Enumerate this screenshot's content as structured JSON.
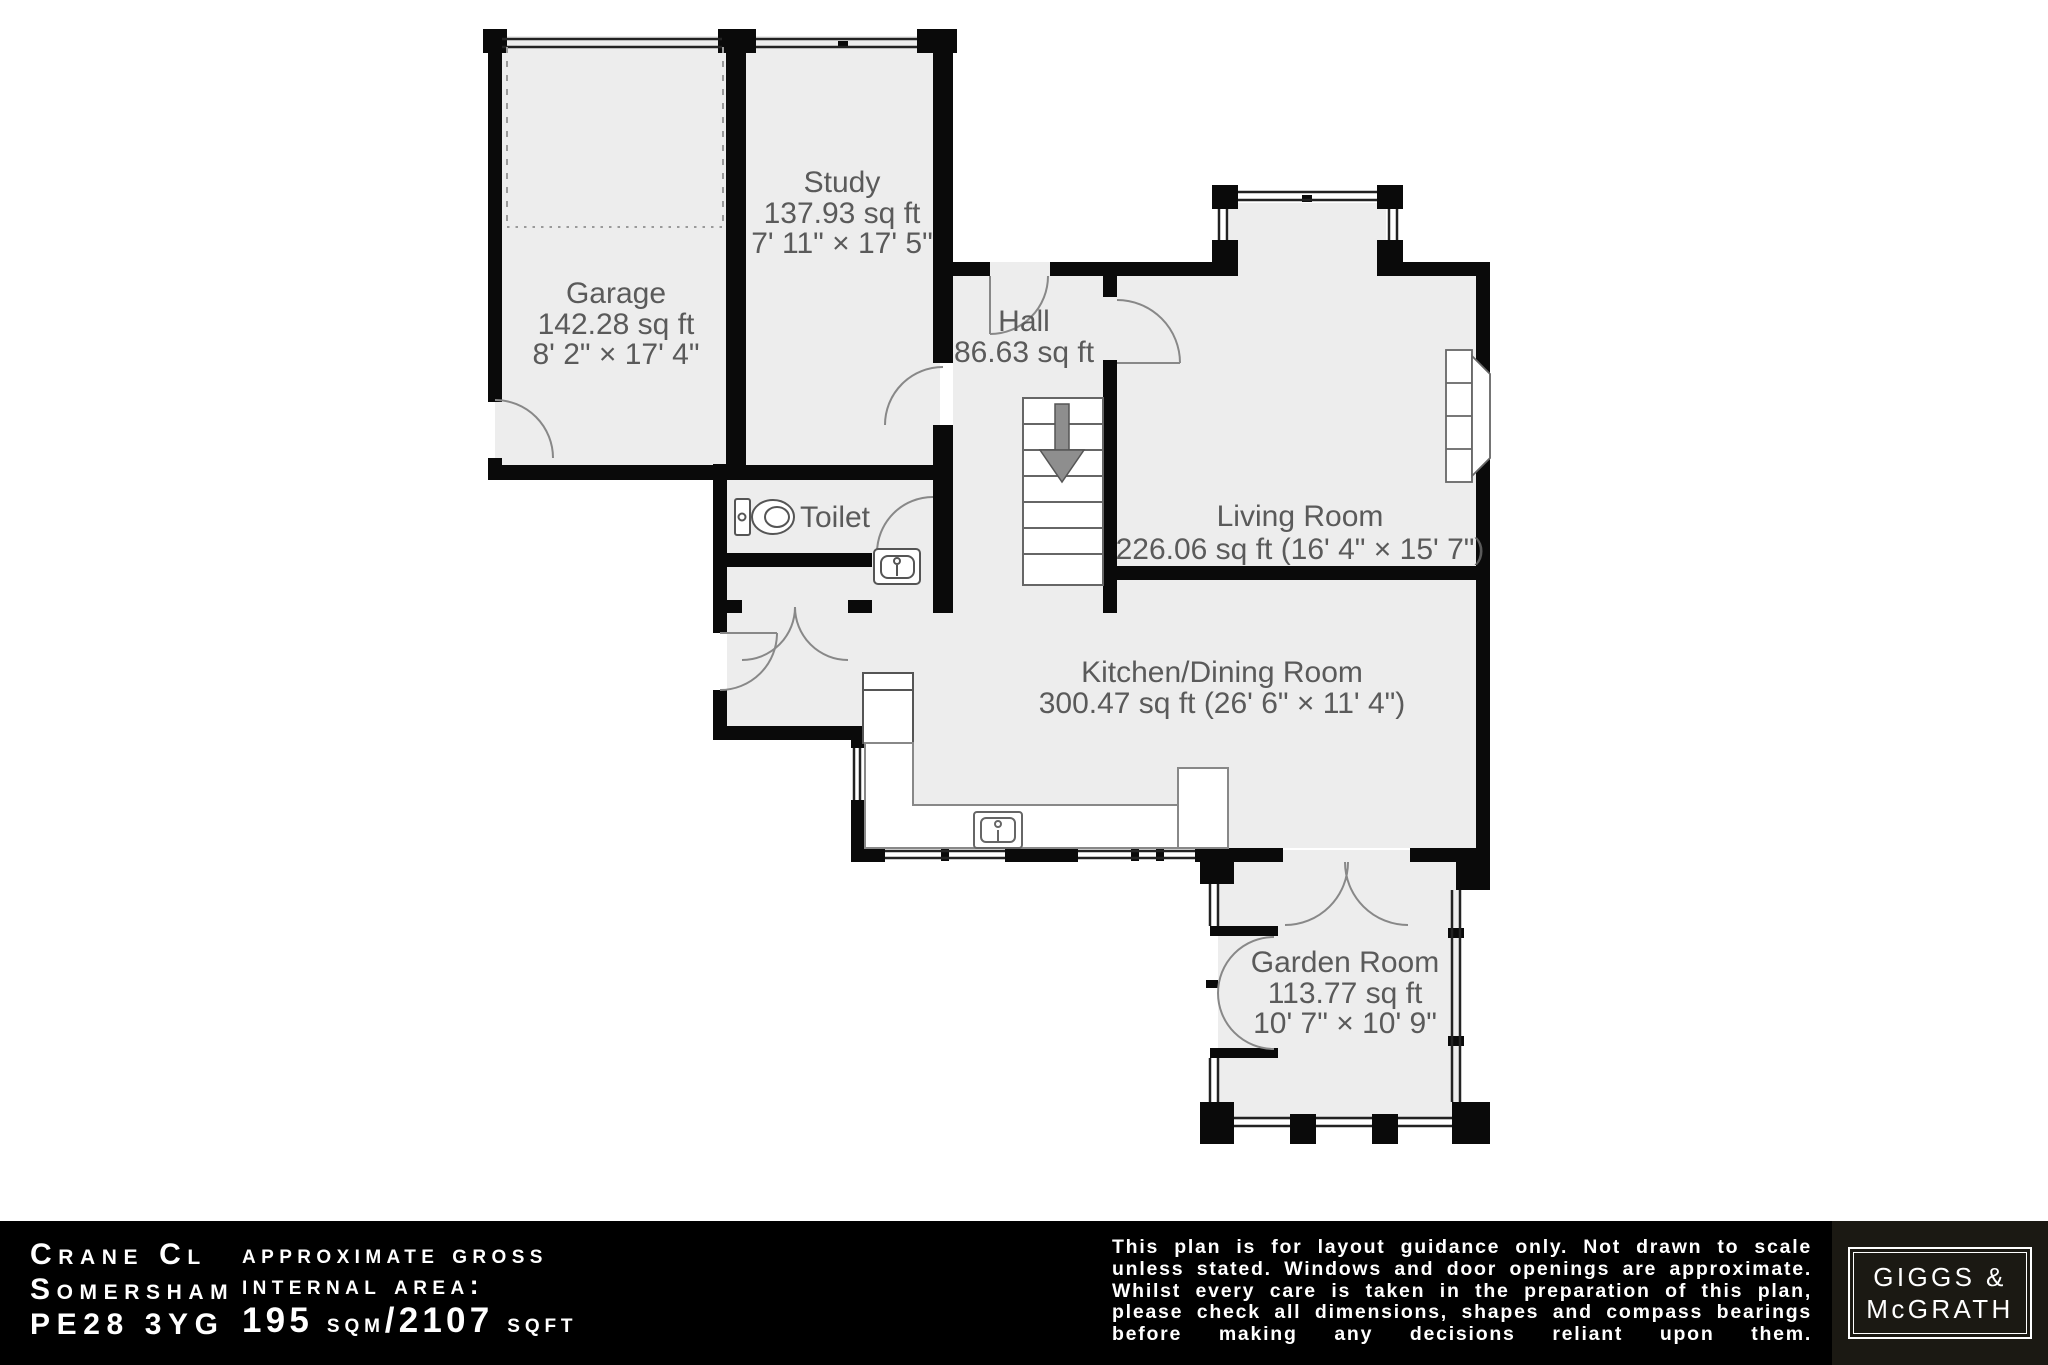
{
  "rooms": {
    "garage": {
      "name": "Garage",
      "area": "142.28 sq ft",
      "dims": "8' 2\" × 17' 4\""
    },
    "study": {
      "name": "Study",
      "area": "137.93 sq ft",
      "dims": "7' 11\" × 17' 5\""
    },
    "hall": {
      "name": "Hall",
      "area": "86.63 sq ft"
    },
    "toilet": {
      "name": "Toilet"
    },
    "living": {
      "name": "Living Room",
      "area": "226.06 sq ft (16' 4\" × 15' 7\")"
    },
    "kitchen": {
      "name": "Kitchen/Dining Room",
      "area": "300.47 sq ft (26' 6\" × 11' 4\")"
    },
    "garden": {
      "name": "Garden Room",
      "area": "113.77 sq ft",
      "dims": "10' 7\" × 10' 9\""
    }
  },
  "footer": {
    "address_line1": "Crane Cl",
    "address_line2": "Somersham",
    "address_line3": "PE28 3YG",
    "area_label_line1": "approximate gross",
    "area_label_line2": "internal area:",
    "area_value_num1": "195 ",
    "area_value_unit1": "sqm",
    "area_value_num2": "/2107 ",
    "area_value_unit2": "sqft",
    "disclaimer": "This plan is for layout guidance only. Not drawn to scale unless stated. Windows and door openings are approximate. Whilst every care is taken in the preparation of this plan, please check all dimensions, shapes and compass bearings before making any decisions reliant upon them.",
    "logo_line1": "GIGGS &",
    "logo_line2": "McGRATH"
  },
  "colors": {
    "room_fill": "#ededed",
    "wall": "#0a0a0a",
    "label_text": "#5a5a5a",
    "footer_bg": "#000000",
    "logo_bg": "#1b1913"
  }
}
